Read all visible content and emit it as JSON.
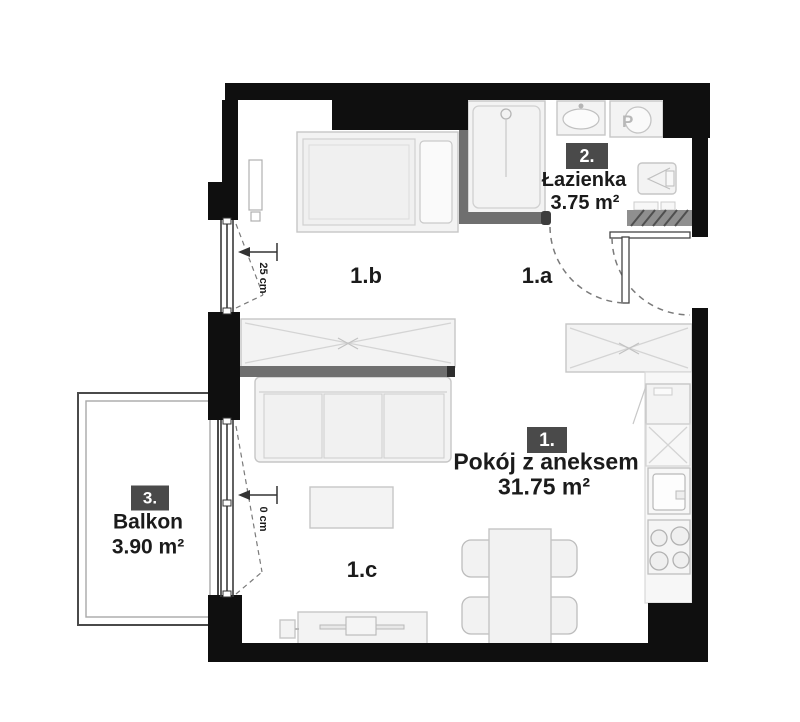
{
  "colors": {
    "wall": "#0f0f0f",
    "partition": "#6f6f6f",
    "badge-bg": "#4a4a4a",
    "badge-text": "#ffffff",
    "furniture-fill": "#f3f3f3",
    "furniture-stroke": "#c6c6c6",
    "detail-stroke": "#d4d4d4",
    "label-text": "#1b1b1b",
    "dash": "#7a7a7a",
    "frame": "#3a3a3a"
  },
  "plan": {
    "rooms": [
      {
        "number": "1.",
        "name": "Pokój z aneksem",
        "area": "31.75 m²"
      },
      {
        "number": "2.",
        "name": "Łazienka",
        "area": "3.75 m²"
      },
      {
        "number": "3.",
        "name": "Balkon",
        "area": "3.90 m²"
      }
    ],
    "zones": [
      {
        "label": "1.a"
      },
      {
        "label": "1.b"
      },
      {
        "label": "1.c"
      }
    ],
    "dimensions": [
      {
        "label": "25 cm"
      },
      {
        "label": "0 cm"
      }
    ],
    "appliances": {
      "washer_label": "P"
    }
  }
}
